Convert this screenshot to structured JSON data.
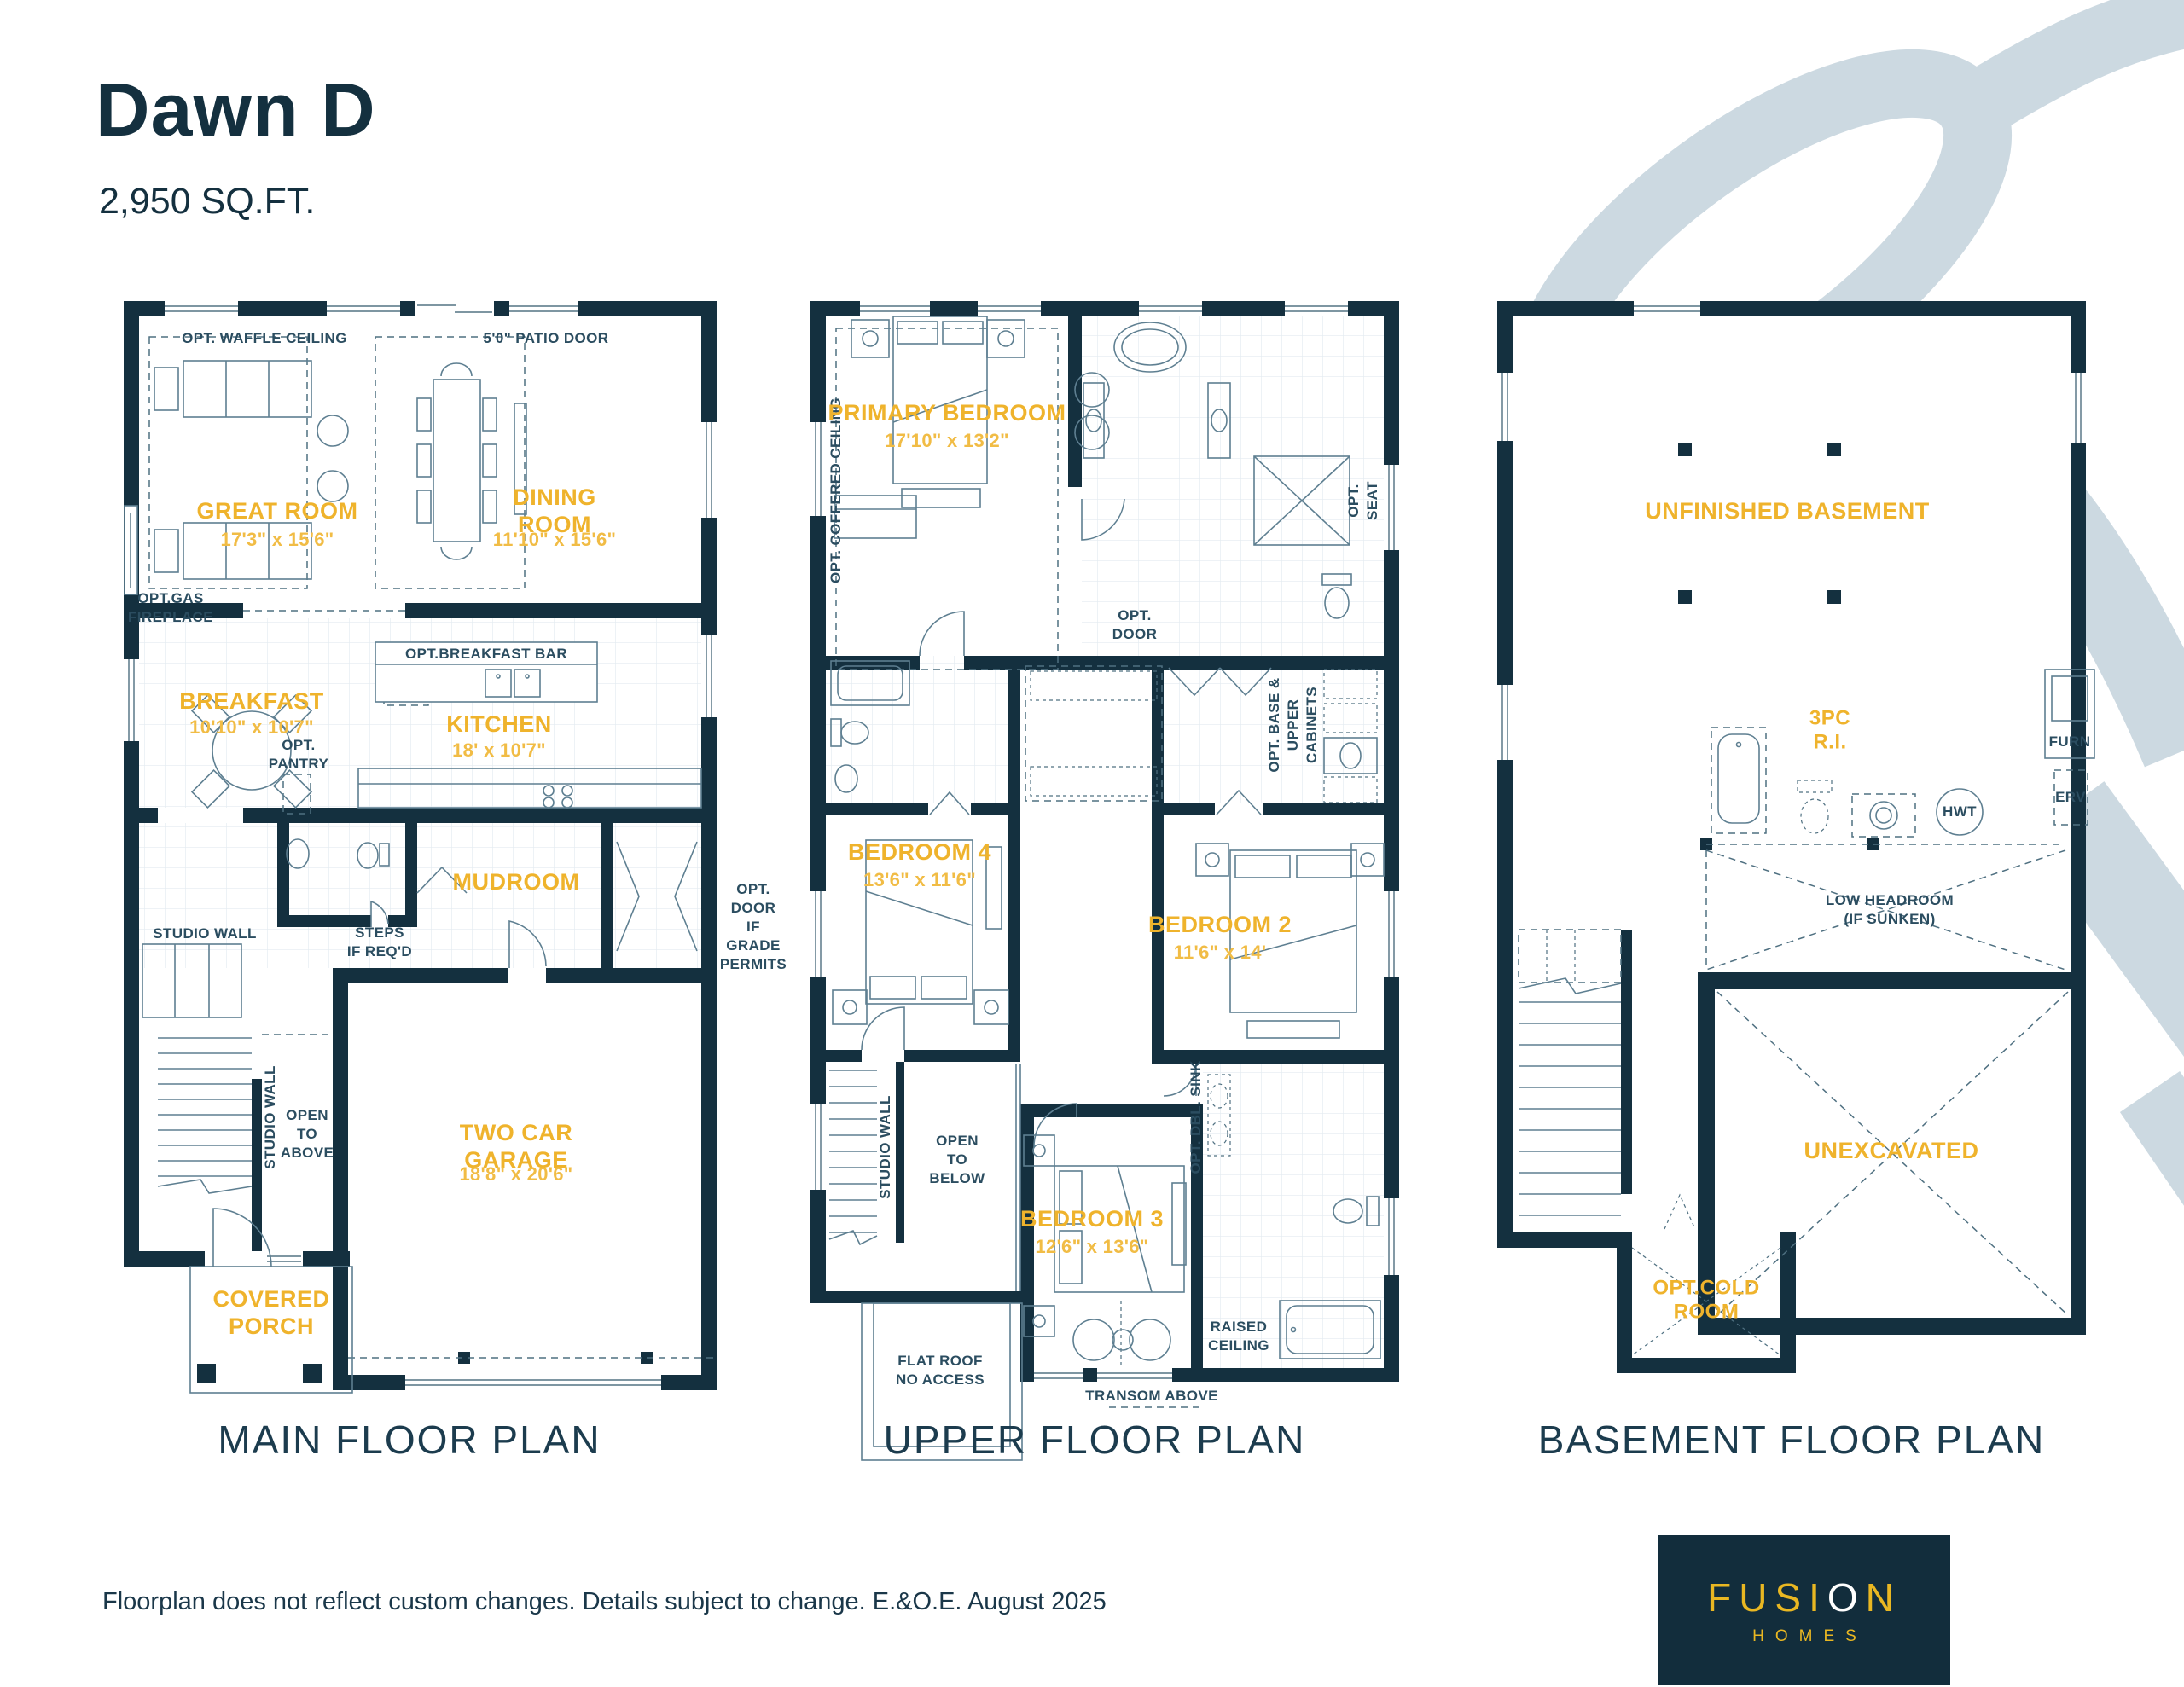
{
  "header": {
    "title": "Dawn D",
    "sqft": "2,950 SQ.FT."
  },
  "colors": {
    "navy": "#14303F",
    "yellow": "#EFB32C",
    "swoosh": "#CCD9E1",
    "logo_bg": "#122D3C"
  },
  "plans": {
    "main": {
      "title": "MAIN FLOOR PLAN",
      "rooms": {
        "great": {
          "name": "GREAT ROOM",
          "dims": "17'3\" x 15'6\""
        },
        "dining": {
          "name": "DINING ROOM",
          "dims": "11'10\" x 15'6\""
        },
        "breakfast": {
          "name": "BREAKFAST",
          "dims": "10'10\" x 10'7\""
        },
        "kitchen": {
          "name": "KITCHEN",
          "dims": "18' x 10'7\""
        },
        "mudroom": {
          "name": "MUDROOM"
        },
        "garage": {
          "name": "TWO CAR GARAGE",
          "dims": "18'8\" x 20'6\""
        },
        "porch": {
          "name": "COVERED\nPORCH"
        }
      },
      "ann": {
        "waffle": "OPT. WAFFLE CEILING",
        "patio": "5'0\" PATIO DOOR",
        "fireplace": "OPT.GAS\nFIREPLACE",
        "bar": "OPT.BREAKFAST BAR",
        "pantry": "OPT.\nPANTRY",
        "steps": "STEPS\nIF REQ'D",
        "studio_h": "STUDIO WALL",
        "studio_v": "STUDIO WALL",
        "open_above": "OPEN\nTO\nABOVE",
        "grade": "OPT. DOOR\nIF GRADE\nPERMITS"
      }
    },
    "upper": {
      "title": "UPPER FLOOR PLAN",
      "rooms": {
        "primary": {
          "name": "PRIMARY BEDROOM",
          "dims": "17'10\" x 13'2\""
        },
        "b4": {
          "name": "BEDROOM 4",
          "dims": "13'6\" x 11'6\""
        },
        "b2": {
          "name": "BEDROOM 2",
          "dims": "11'6\" x 14'"
        },
        "b3": {
          "name": "BEDROOM 3",
          "dims": "12'6\" x 13'6\""
        }
      },
      "ann": {
        "coffered": "OPT. COFFERED CEILING",
        "seat": "OPT. SEAT",
        "door": "OPT.\nDOOR",
        "cabinets": "OPT. BASE & UPPER\nCABINETS",
        "studio": "STUDIO WALL",
        "open_below": "OPEN\nTO\nBELOW",
        "dblsink": "OPT. DBL. SINK",
        "flatroof": "FLAT ROOF\nNO ACCESS",
        "raised": "RAISED\nCEILING",
        "transom": "TRANSOM ABOVE"
      }
    },
    "basement": {
      "title": "BASEMENT FLOOR PLAN",
      "rooms": {
        "unfinished": {
          "name": "UNFINISHED BASEMENT"
        },
        "unexcavated": {
          "name": "UNEXCAVATED"
        },
        "cold": {
          "name": "OPT.COLD\nROOM"
        },
        "threepc": {
          "name": "3PC\nR.I."
        }
      },
      "ann": {
        "furn": "FURN",
        "erv": "ERV",
        "hwt": "HWT",
        "low": "LOW HEADROOM\n(IF SUNKEN)"
      }
    }
  },
  "footer": {
    "disclaimer": "Floorplan does not reflect custom changes. Details subject to change. E.&O.E. August 2025",
    "logo": {
      "fusion_pre": "FUSI",
      "fusion_o": "O",
      "fusion_post": "N",
      "homes": "HOMES"
    }
  }
}
